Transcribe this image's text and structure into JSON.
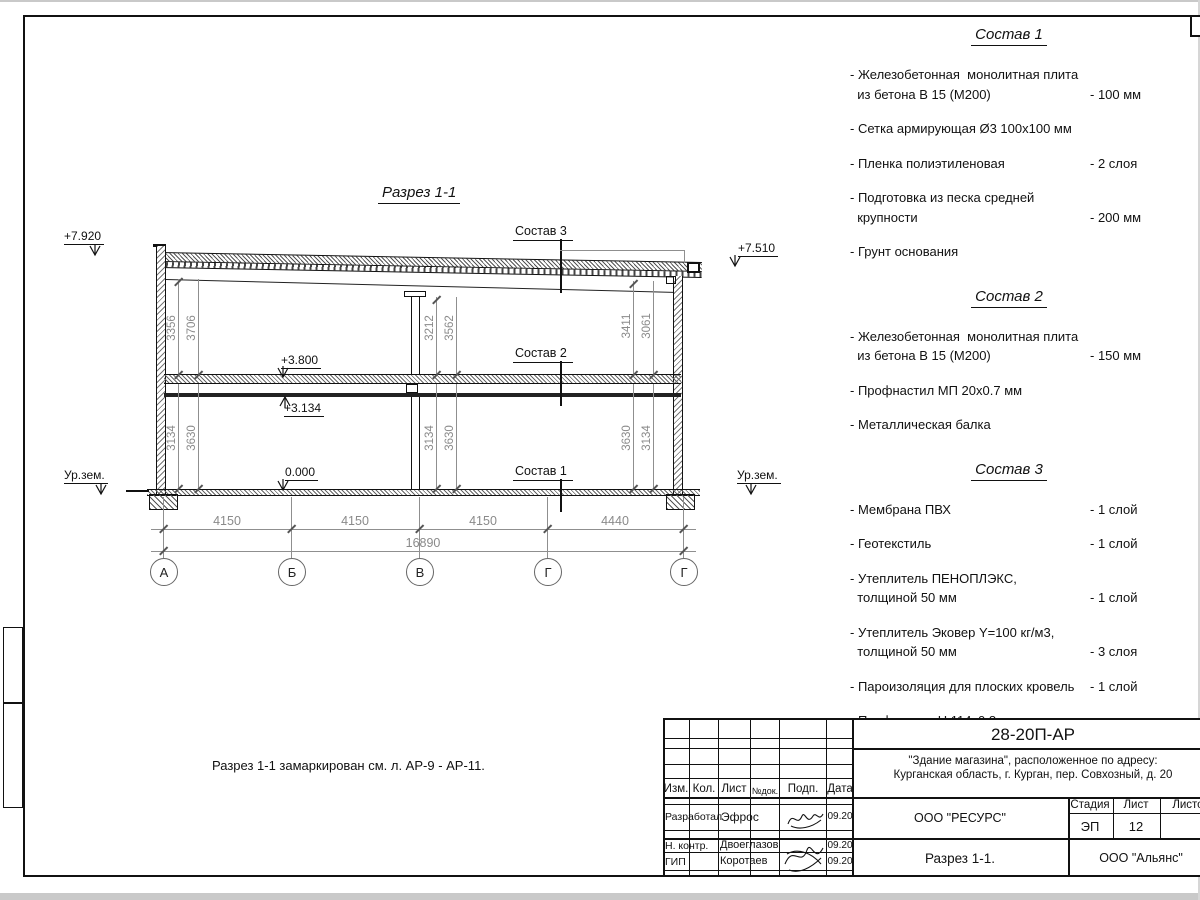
{
  "drawing": {
    "title": "Разрез 1-1",
    "note": "Разрез 1-1 замаркирован см. л. АР-9 - АР-11.",
    "levels": {
      "roof_left": "+7.920",
      "roof_right": "+7.510",
      "floor2": "+3.800",
      "beam": "+3.134",
      "zero": "0.000",
      "ground_left": "Ур.зем.",
      "ground_right": "Ур.зем."
    },
    "callouts": {
      "c3": "Состав 3",
      "c2": "Состав 2",
      "c1": "Состав 1"
    },
    "axes": [
      "А",
      "Б",
      "В",
      "Г",
      "Г"
    ],
    "span_dims": [
      "4150",
      "4150",
      "4150",
      "4440"
    ],
    "total_dim": "16890",
    "vdims": {
      "left_upper": [
        "3356",
        "3706"
      ],
      "left_lower": [
        "3134",
        "3630"
      ],
      "mid_upper": [
        "3212",
        "3562"
      ],
      "mid_lower": [
        "3134",
        "3630"
      ],
      "right_upper": [
        "3411",
        "3061"
      ],
      "right_lower": [
        "3630",
        "3134"
      ]
    }
  },
  "compositions": [
    {
      "title": "Состав 1",
      "items": [
        {
          "name": "- Железобетонная  монолитная плита\n  из бетона В 15 (М200)",
          "value": "- 100 мм"
        },
        {
          "name": "- Сетка армирующая Ø3 100х100 мм",
          "value": ""
        },
        {
          "name": "- Пленка полиэтиленовая",
          "value": "-  2 слоя"
        },
        {
          "name": "- Подготовка из песка средней\n  крупности",
          "value": "- 200 мм"
        },
        {
          "name": "- Грунт основания",
          "value": ""
        }
      ]
    },
    {
      "title": "Состав 2",
      "items": [
        {
          "name": "- Железобетонная  монолитная плита\n  из бетона В 15 (М200)",
          "value": "- 150 мм"
        },
        {
          "name": "- Профнастил МП 20х0.7 мм",
          "value": ""
        },
        {
          "name": "- Металлическая балка",
          "value": ""
        }
      ]
    },
    {
      "title": "Состав 3",
      "items": [
        {
          "name": "- Мембрана ПВХ",
          "value": "- 1 слой"
        },
        {
          "name": "- Геотекстиль",
          "value": "- 1 слой"
        },
        {
          "name": "- Утеплитель ПЕНОПЛЭКС,\n  толщиной 50 мм",
          "value": "- 1 слой"
        },
        {
          "name": "- Утеплитель Эковер Y=100 кг/м3,\n  толщиной 50 мм",
          "value": "- 3 слоя"
        },
        {
          "name": "- Пароизоляция для плоских кровель",
          "value": "- 1 слой"
        },
        {
          "name": "- Профнастил Н 114х0.8 мм",
          "value": ""
        },
        {
          "name": "- Металлическая балка",
          "value": ""
        }
      ]
    }
  ],
  "titleblock": {
    "doc_number": "28-20П-АР",
    "project_line1": "\"Здание магазина\", расположенное по адресу:",
    "project_line2": "Курганская область, г. Курган, пер. Совхозный, д. 20",
    "cols": [
      "Изм.",
      "Кол.",
      "Лист",
      "№док.",
      "Подп.",
      "Дата"
    ],
    "rows": [
      {
        "role": "Разработал",
        "name": "Эфрос",
        "date": "09.20"
      },
      {
        "role": "Н. контр.",
        "name": "Двоеглазов",
        "date": "09.20"
      },
      {
        "role": "ГИП",
        "name": "Коротаев",
        "date": "09.20"
      }
    ],
    "org_designer": "ООО \"РЕСУРС\"",
    "stage_label": "Стадия",
    "stage_value": "ЭП",
    "sheet_label": "Лист",
    "sheet_value": "12",
    "sheets_label": "Листов",
    "drawing_name": "Разрез 1-1.",
    "org_customer": "ООО \"Альянс\""
  }
}
